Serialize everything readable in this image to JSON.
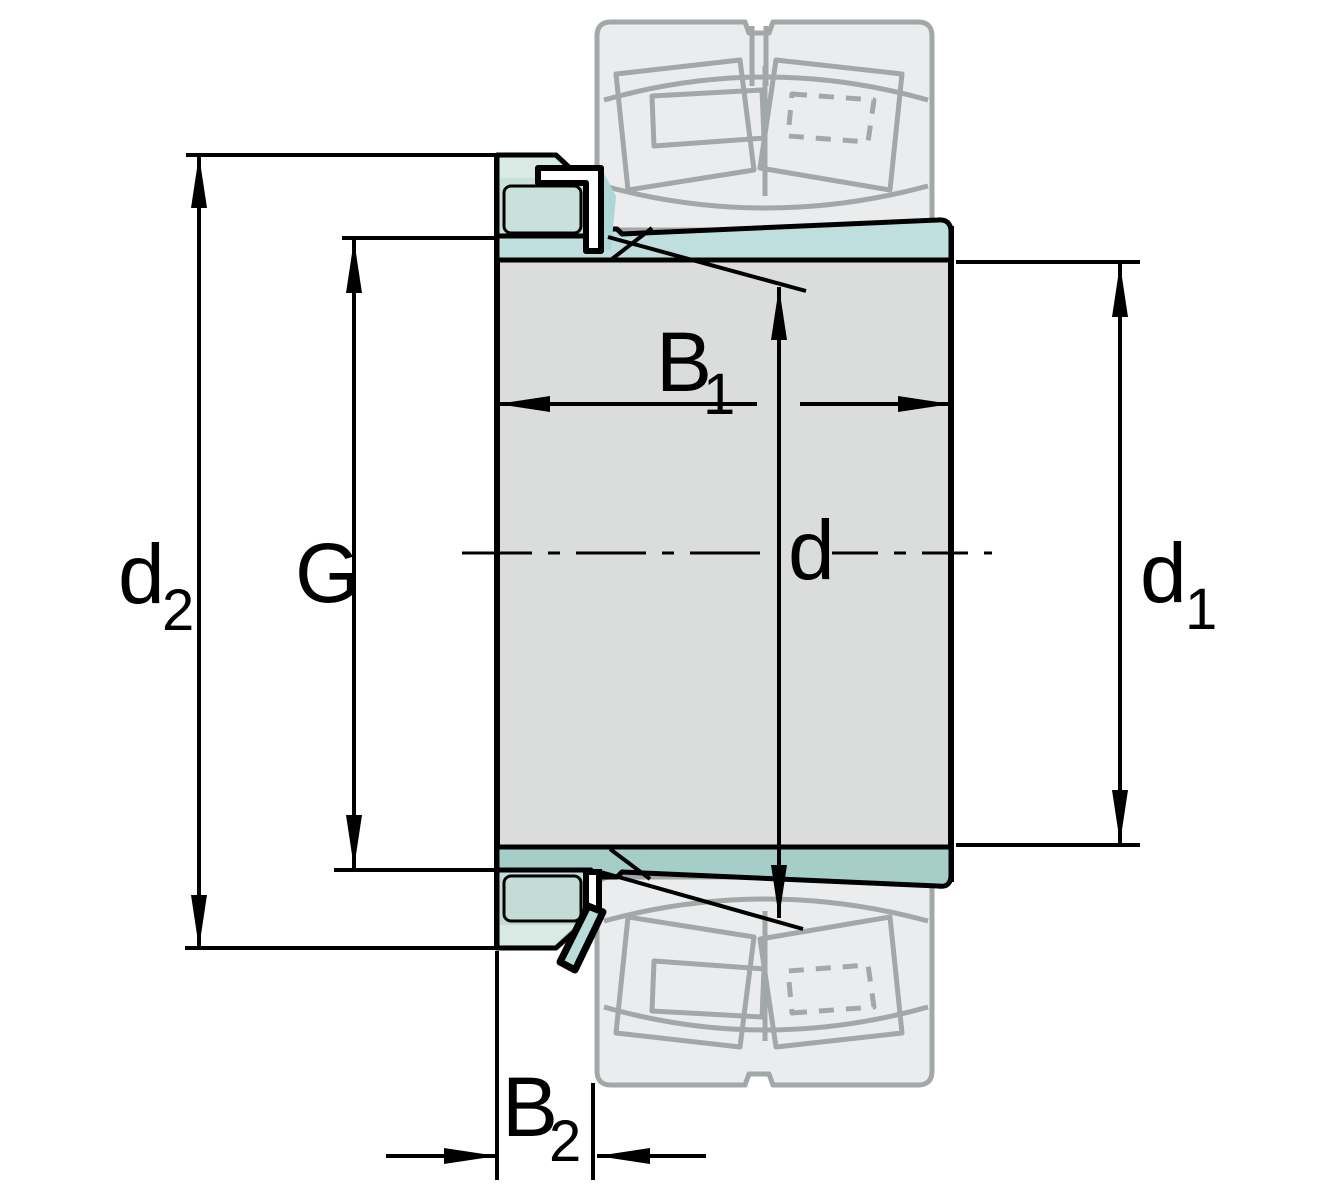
{
  "diagram": {
    "title": "adapter-sleeve-cross-section",
    "labels": {
      "d2": {
        "base": "d",
        "sub": "2"
      },
      "G": {
        "base": "G",
        "sub": ""
      },
      "B1": {
        "base": "B",
        "sub": "1"
      },
      "d": {
        "base": "d",
        "sub": ""
      },
      "d1": {
        "base": "d",
        "sub": "1"
      },
      "B2": {
        "base": "B",
        "sub": "2"
      }
    },
    "colors": {
      "background": "#ffffff",
      "outline": "#000000",
      "shaft_gray": "#dbdcdc",
      "sleeve_top_teal": "#bfdfde",
      "sleeve_bottom_teal": "#a6cec9",
      "nut_fill": "#c9e1db",
      "nut_light_strip": "#d9eae5",
      "washer_teal": "#aed6d6",
      "ghost_fill": "#ebeced",
      "ghost_stroke": "#a2a7a7"
    }
  }
}
